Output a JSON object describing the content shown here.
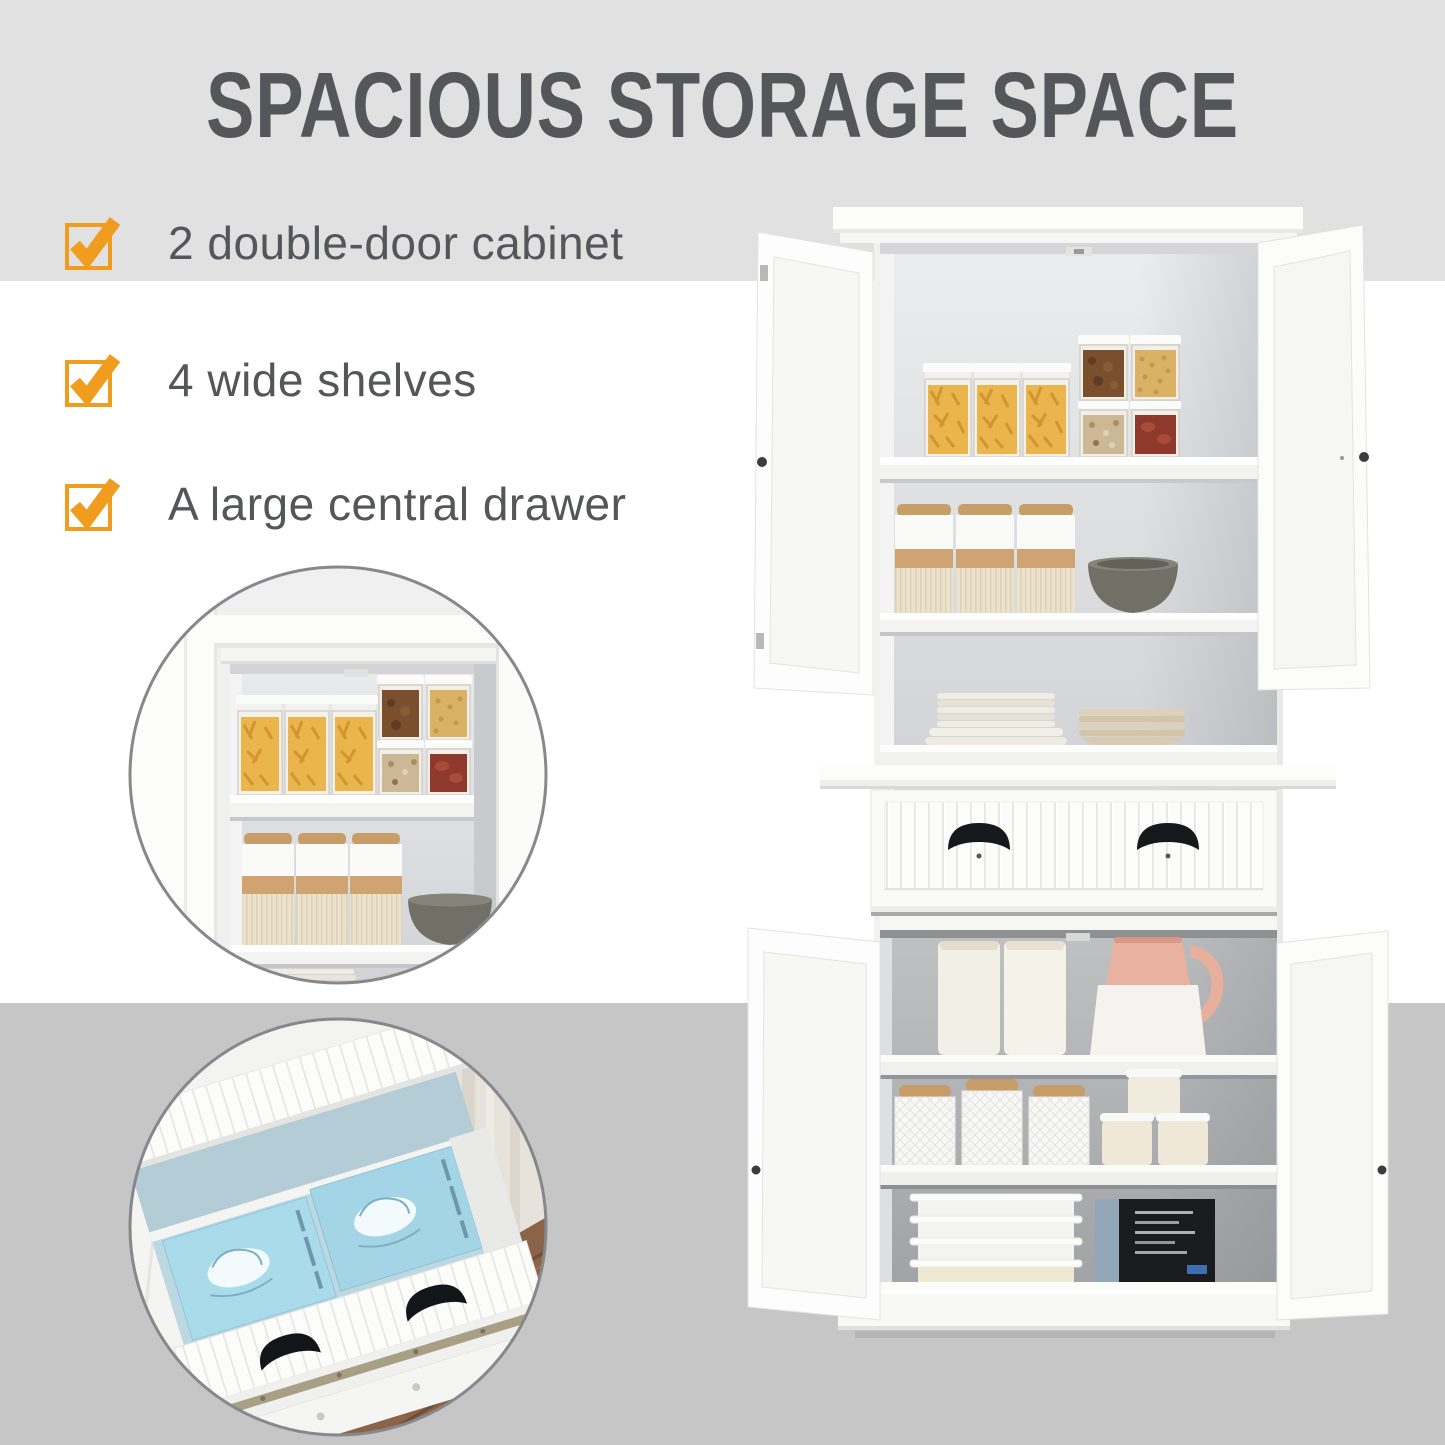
{
  "title": "SPACIOUS STORAGE SPACE",
  "features": [
    {
      "icon": "checked-checkbox-icon",
      "label": "2 double-door cabinet"
    },
    {
      "icon": "checked-checkbox-icon",
      "label": "4 wide shelves"
    },
    {
      "icon": "checked-checkbox-icon",
      "label": "A large central drawer"
    }
  ],
  "colors": {
    "accent_orange": "#F09D1F",
    "text_gray": "#55565A",
    "band_top": "#E1E1E2",
    "band_middle": "#FFFFFF",
    "band_bottom": "#C6C6C7",
    "drawer_box_blue": "#A9DBEB",
    "wood_floor_brown": "#8A6348",
    "handle_black": "#17181B"
  }
}
